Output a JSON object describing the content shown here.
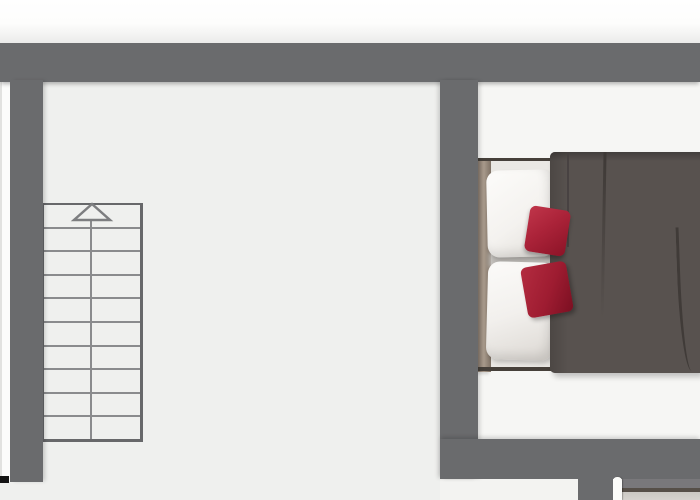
{
  "scene": {
    "type": "floor-plan-top-view",
    "rooms": [
      {
        "id": "left-room",
        "floor_color": "#eff0ee",
        "contents": [
          "staircase",
          "closet-strip"
        ]
      },
      {
        "id": "bedroom",
        "floor_color": "#f6f6f4",
        "contents": [
          "double-bed"
        ]
      }
    ],
    "stairs": {
      "step_count": 10,
      "flights": 2,
      "direction_arrow": "up"
    },
    "closet": {
      "segment_count": 3,
      "segment_heights_px": [
        112,
        111,
        118
      ]
    },
    "bed": {
      "white_pillow_count": 2,
      "red_pillow_count": 2,
      "duvet": "dark-gray",
      "frame": "wood"
    },
    "fittings": {
      "door_leaf": 1,
      "sideboard": 1
    }
  },
  "colors": {
    "wall": "#6a6b6d",
    "floor_left_room": "#eff0ee",
    "floor_bedroom": "#f6f6f4",
    "outside": "#fcfcfb",
    "stair_line": "#8a8b8d",
    "stair_border": "#67686a",
    "closet_white": "#fafaf9",
    "bed_frame_wood": "#9c8e80",
    "mattress": "#eae8e4",
    "pillow_white": "#f5f3f0",
    "pillow_red": "#ab2339",
    "pillow_red_dark": "#9e1c31",
    "duvet": "#58524f",
    "sideboard_top": "#564f48",
    "corner_mark": "#141414"
  }
}
